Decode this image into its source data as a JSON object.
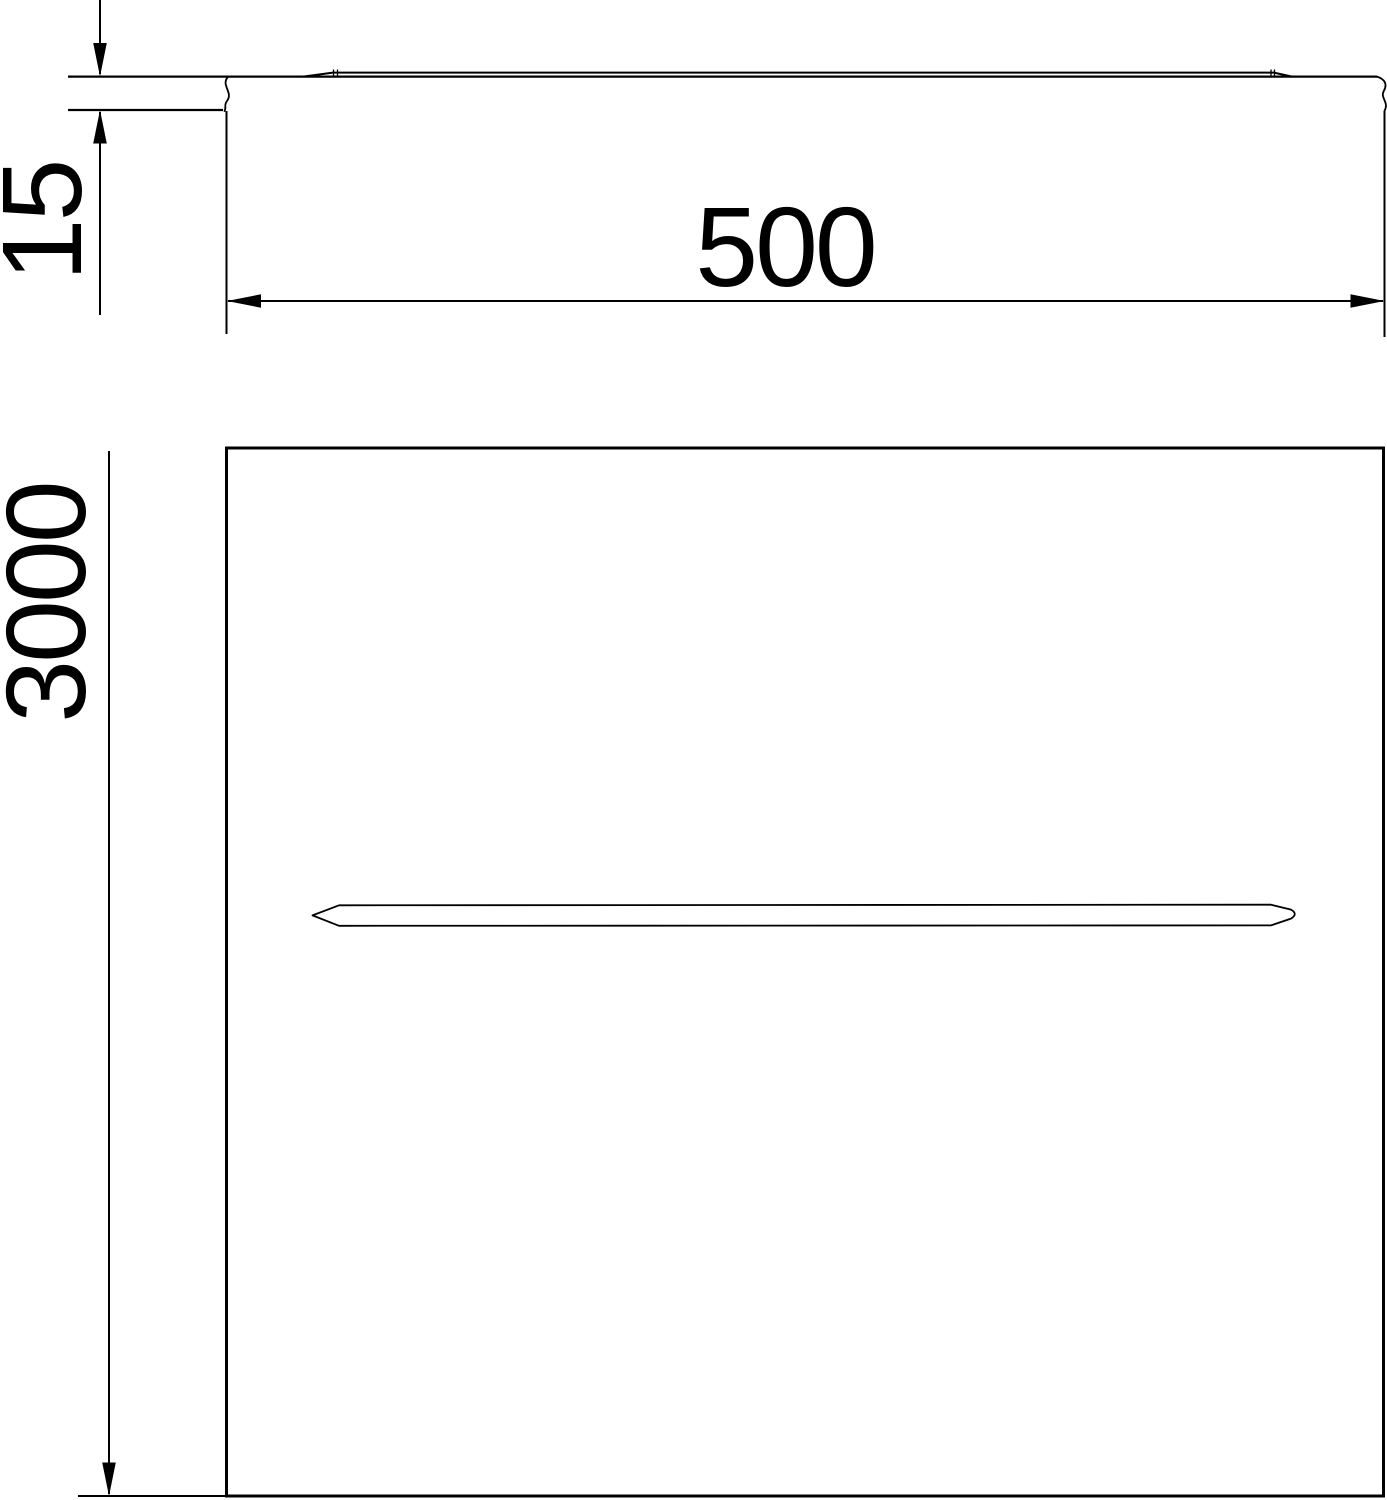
{
  "colors": {
    "background": "#ffffff",
    "line": "#000000"
  },
  "views": {
    "side_view": {
      "description": "edge profile of cover sheet with break symbols and raised surface bead"
    },
    "top_view": {
      "description": "rectangular cover panel with central longitudinal embossed slot"
    }
  },
  "dimensions": {
    "thickness": {
      "label": "15"
    },
    "width": {
      "label": "500"
    },
    "length": {
      "label": "3000"
    }
  }
}
